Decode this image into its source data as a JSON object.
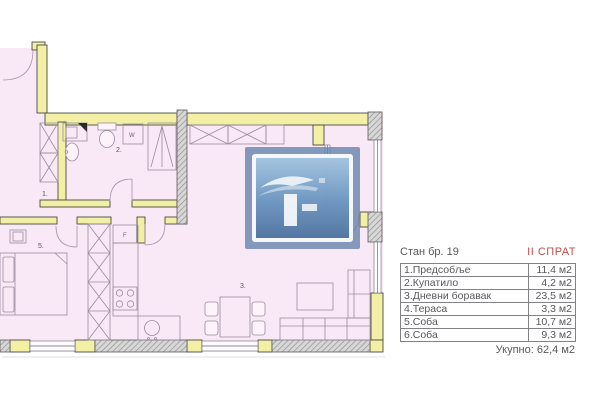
{
  "colors": {
    "floor_pink": "#f9e9f6",
    "wall_yellow": "#f3efa5",
    "accent_red": "#c0504d",
    "logo_blue": "#6182aa",
    "text_gray": "#58585c"
  },
  "plan": {
    "room_labels": {
      "hall": "1.",
      "bathroom": "2.",
      "living": "3.",
      "terrace": "4.",
      "bedroom": "5."
    },
    "fixture_labels": {
      "washer": "W",
      "fridge": "F"
    }
  },
  "legend": {
    "title": "Стан бр. 19",
    "floor": "II СПРАТ",
    "rows": [
      {
        "label": "1.Предсобље",
        "value": "11,4 м2"
      },
      {
        "label": "2.Купатило",
        "value": "4,2 м2"
      },
      {
        "label": "3.Дневни боравак",
        "value": "23,5 м2"
      },
      {
        "label": "4.Тераса",
        "value": "3,3 м2"
      },
      {
        "label": "5.Соба",
        "value": "10,7 м2"
      },
      {
        "label": "6.Соба",
        "value": "9,3 м2"
      }
    ],
    "total": "Укупно: 62,4 м2"
  }
}
